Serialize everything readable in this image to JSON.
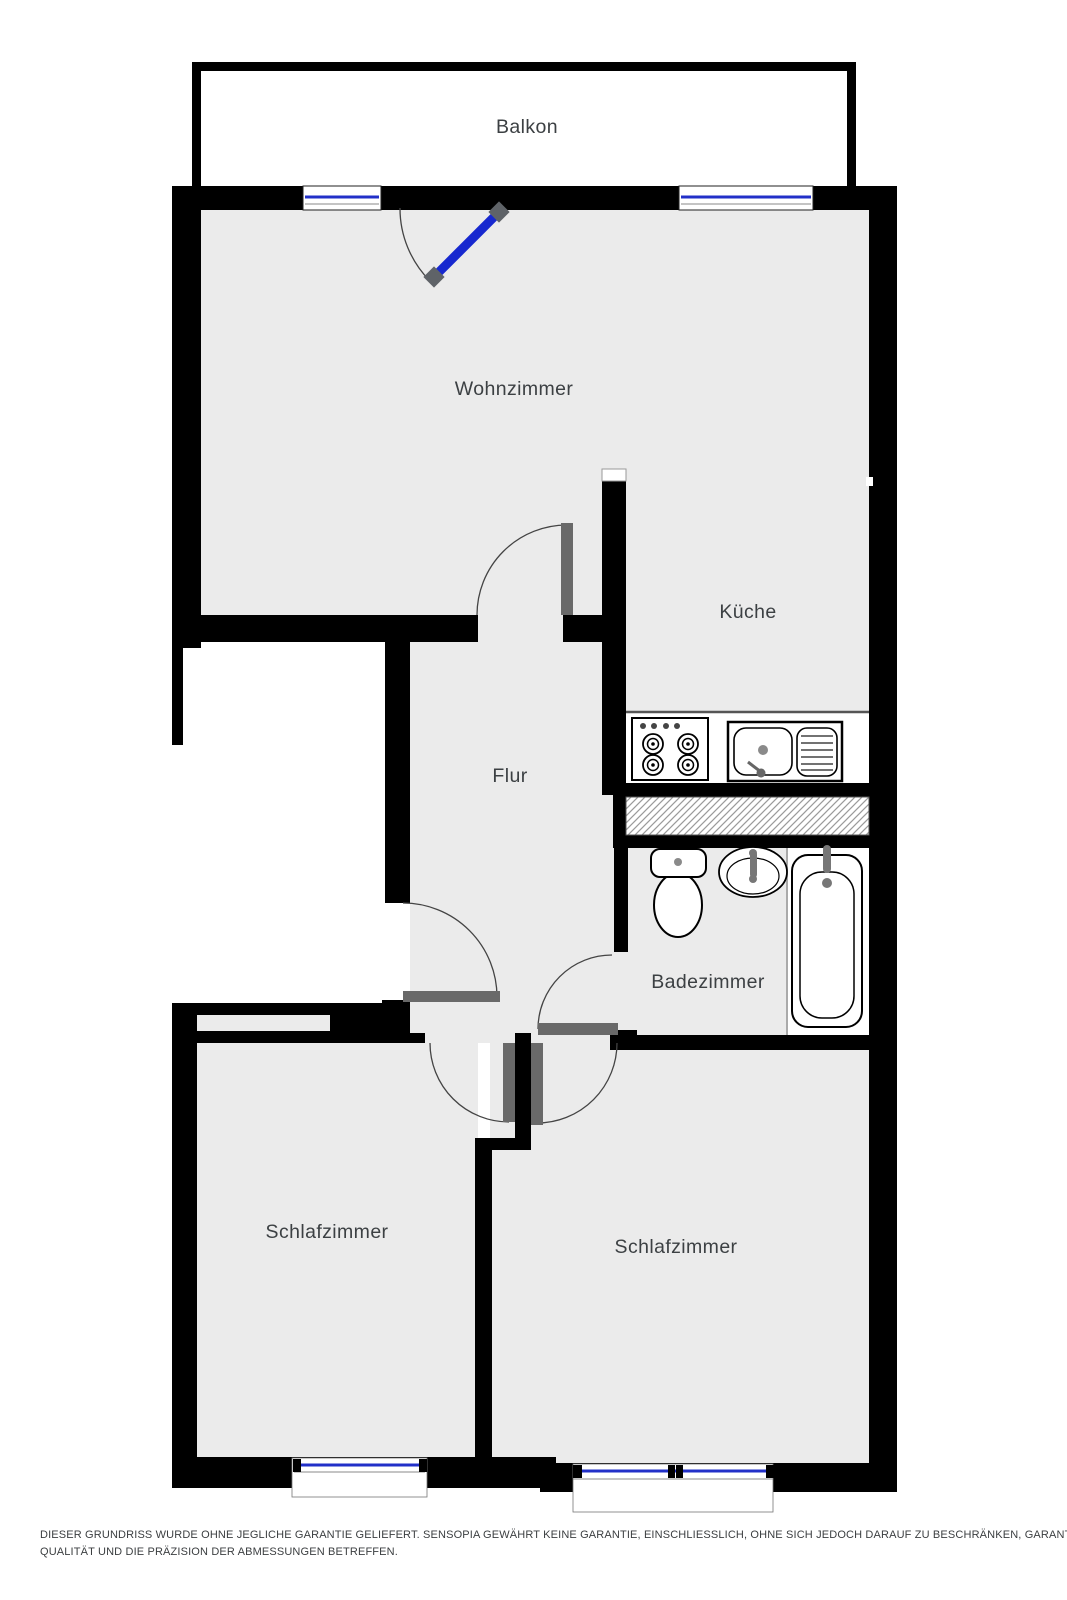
{
  "document": {
    "type": "floor-plan"
  },
  "rooms": {
    "balkon": {
      "label": "Balkon"
    },
    "wohnzimmer": {
      "label": "Wohnzimmer"
    },
    "kueche": {
      "label": "Küche"
    },
    "flur": {
      "label": "Flur"
    },
    "badezimmer": {
      "label": "Badezimmer"
    },
    "schlafzimmer_links": {
      "label": "Schlafzimmer"
    },
    "schlafzimmer_rechts": {
      "label": "Schlafzimmer"
    }
  },
  "fixtures": {
    "kitchen": [
      "stove-icon",
      "kitchen-sink-icon"
    ],
    "bathroom": [
      "toilet-icon",
      "washbasin-icon",
      "bathtub-icon"
    ]
  },
  "colors": {
    "wall": "#000000",
    "floor": "#ebebeb",
    "outside": "#ffffff",
    "window_blue": "#2230c8",
    "balcony_door_blue": "#1728cf",
    "door_leaf_gray": "#696969"
  },
  "disclaimer": {
    "line1": "DIESER GRUNDRISS WURDE OHNE JEGLICHE GARANTIE GELIEFERT. SENSOPIA GEWÄHRT KEINE GARANTIE, EINSCHLIESSLICH, OHNE SICH JEDOCH DARAUF ZU BESCHRÄNKEN, GARANTIEN, DIE DIE",
    "line2": "QUALITÄT UND DIE PRÄZISION DER ABMESSUNGEN BETREFFEN."
  }
}
